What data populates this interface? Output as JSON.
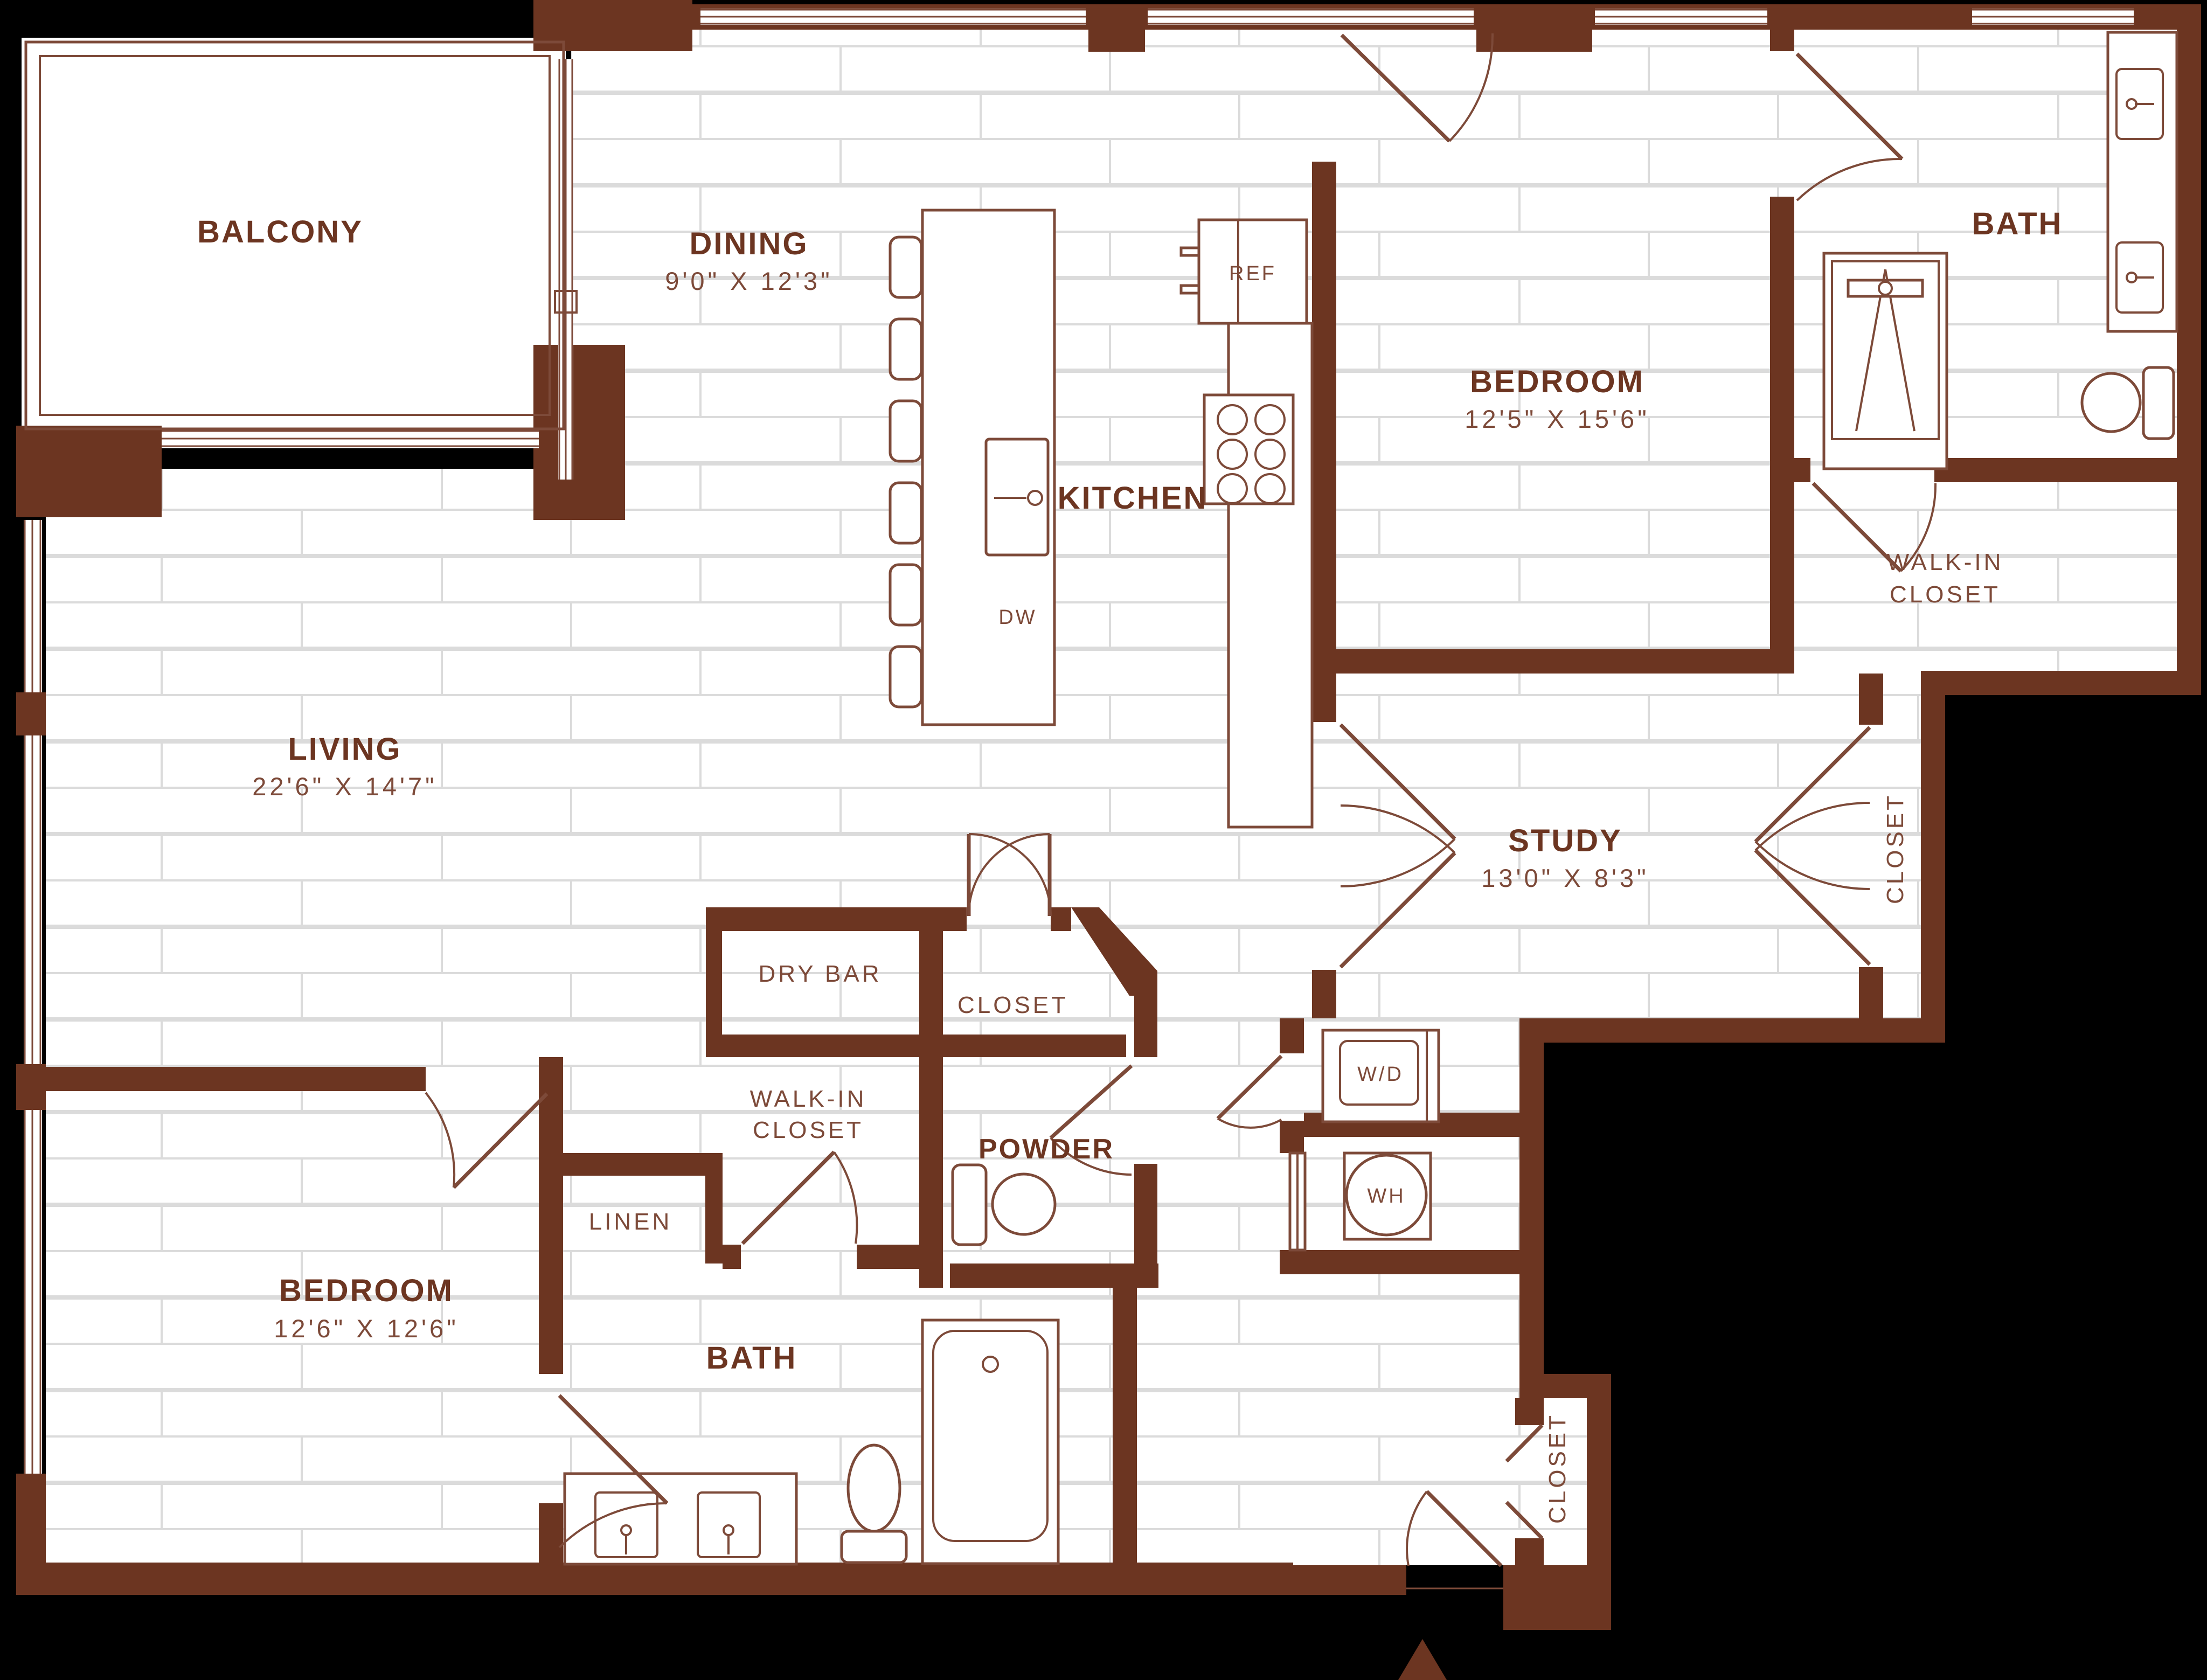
{
  "plan": {
    "type": "apartment-floor-plan",
    "colors": {
      "background": "#000000",
      "wall": "#6C3521",
      "label": "#6C3521",
      "line": "#7D4A39",
      "floor": "#FFFFFF",
      "grout": "#DBDBDB"
    }
  },
  "rooms": {
    "balcony": {
      "label": "BALCONY"
    },
    "dining": {
      "label": "DINING",
      "dims": "9'0\" X 12'3\""
    },
    "kitchen": {
      "label": "KITCHEN"
    },
    "bedroom_2": {
      "label": "BEDROOM",
      "dims": "12'5\" X 15'6\""
    },
    "bath_2": {
      "label": "BATH"
    },
    "walkin_2": {
      "line1": "WALK-IN",
      "line2": "CLOSET"
    },
    "living": {
      "label": "LIVING",
      "dims": "22'6\" X 14'7\""
    },
    "study": {
      "label": "STUDY",
      "dims": "13'0\" X 8'3\""
    },
    "study_closet": {
      "label": "CLOSET"
    },
    "dry_bar": {
      "label": "DRY BAR"
    },
    "hall_closet": {
      "label": "CLOSET"
    },
    "powder": {
      "label": "POWDER"
    },
    "walkin_1": {
      "line1": "WALK-IN",
      "line2": "CLOSET"
    },
    "linen": {
      "label": "LINEN"
    },
    "bath_1": {
      "label": "BATH"
    },
    "bedroom_1": {
      "label": "BEDROOM",
      "dims": "12'6\" X 12'6\""
    },
    "entry_closet": {
      "label": "CLOSET"
    }
  },
  "appliances": {
    "refrigerator": "REF",
    "dishwasher": "DW",
    "washer_dryer": "W/D",
    "water_heater": "WH"
  }
}
